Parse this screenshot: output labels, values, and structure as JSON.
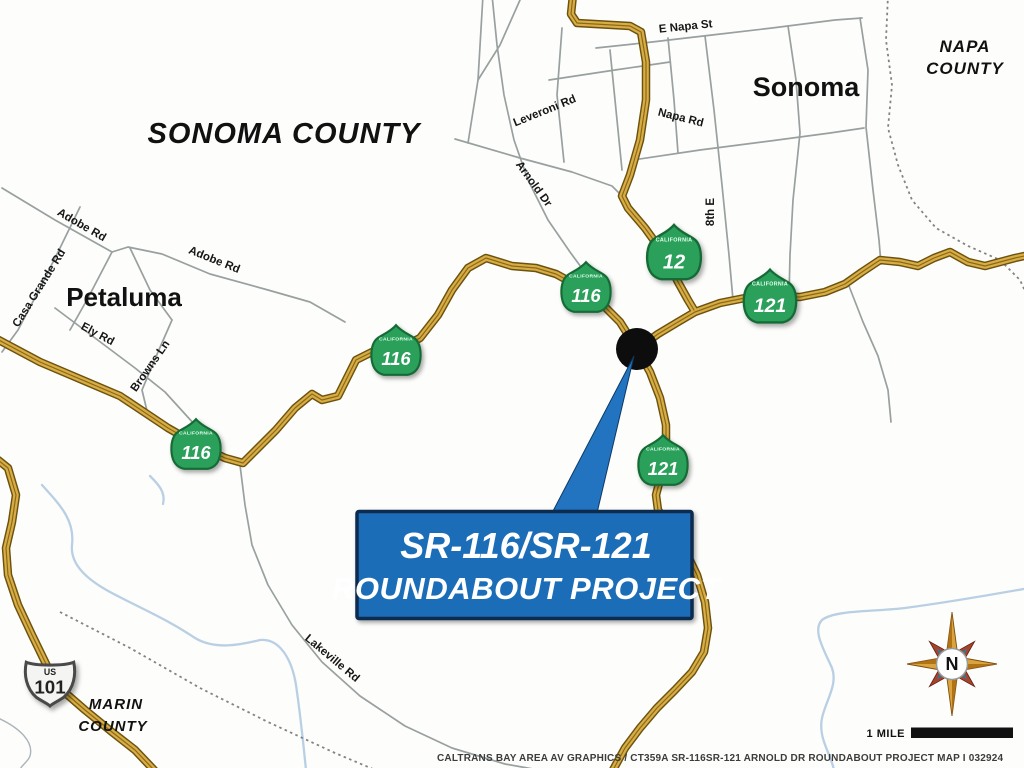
{
  "labels": {
    "sonoma_county": "SONOMA COUNTY",
    "napa_line1": "NAPA",
    "napa_line2": "COUNTY",
    "marin_line1": "MARIN",
    "marin_line2": "COUNTY",
    "city_sonoma": "Sonoma",
    "city_petaluma": "Petaluma"
  },
  "road_labels": {
    "e_napa_st": "E Napa St",
    "leveroni_rd": "Leveroni Rd",
    "napa_rd": "Napa Rd",
    "arnold_dr": "Arnold Dr",
    "eighth_e": "8th E",
    "adobe_rd_west": "Adobe Rd",
    "adobe_rd_east": "Adobe Rd",
    "casa_grande_rd": "Casa Grande Rd",
    "ely_rd": "Ely Rd",
    "browns_ln": "Browns Ln",
    "lakeville_rd": "Lakeville Rd"
  },
  "shields": {
    "state_name": "CALIFORNIA",
    "us_prefix": "US",
    "route_116": "116",
    "route_12": "12",
    "route_121": "121",
    "route_101": "101"
  },
  "callout": {
    "line1": "SR-116/SR-121",
    "line2": "ROUNDABOUT PROJECT"
  },
  "compass": {
    "north_label": "N"
  },
  "scale_bar": {
    "label": "1 MILE"
  },
  "caption": "CALTRANS BAY AREA AV GRAPHICS / CT359A SR-116SR-121 ARNOLD DR  ROUNDABOUT PROJECT MAP I 032924",
  "colors": {
    "highway_fill": "#d9ad45",
    "highway_casing": "#6b5210",
    "minor_road": "#98a0a0",
    "river": "#b9cfe4",
    "shield_green": "#2aa05a",
    "shield_green_dark": "#156b36",
    "callout_blue": "#1b6db8",
    "callout_border": "#0a2c50",
    "marker_black": "#0d0d0d",
    "compass_gold": "#d9a43c",
    "compass_red": "#a8422c",
    "text_black": "#1a1a1a"
  }
}
